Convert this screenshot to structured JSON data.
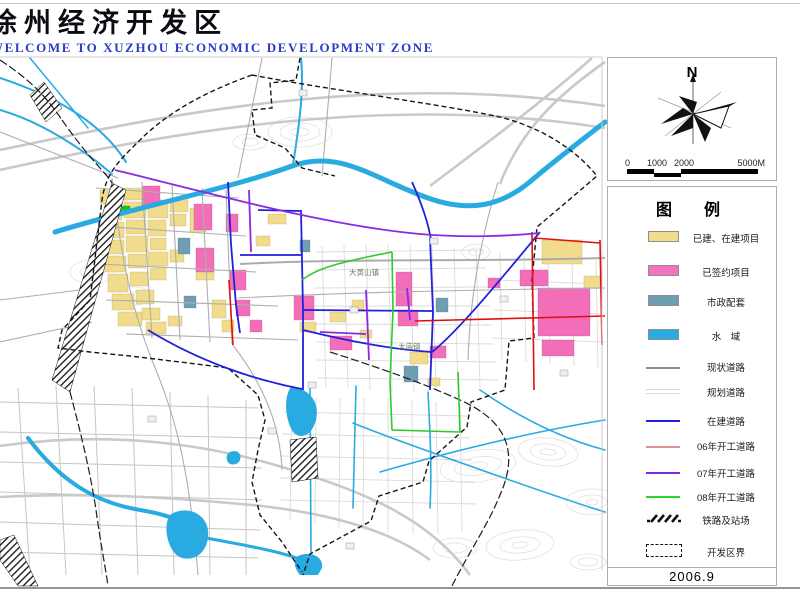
{
  "header": {
    "title": "徐州经济开发区",
    "subtitle": "WELCOME TO XUZHOU ECONOMIC DEVELOPMENT ZONE"
  },
  "compass": {
    "north_label": "N"
  },
  "scale_bar": {
    "ticks": [
      "0",
      "1000",
      "2000",
      "5000M"
    ]
  },
  "legend": {
    "title": "图　例",
    "area_items": [
      {
        "label": "已建、在建项目",
        "color": "#F2DC8E"
      },
      {
        "label": "已签约项目",
        "color": "#F473BC"
      },
      {
        "label": "市政配套",
        "color": "#6F9DB2"
      },
      {
        "label": "水　域",
        "color": "#29ABE2"
      }
    ],
    "line_items": [
      {
        "label": "现状道路",
        "color": "#8C8C8C",
        "style": "solid"
      },
      {
        "label": "规划道路",
        "color": "#D9D9D9",
        "style": "double"
      },
      {
        "label": "在建道路",
        "color": "#2222E0",
        "style": "solid"
      },
      {
        "label": "06年开工道路",
        "color": "#E09090",
        "style": "thin"
      },
      {
        "label": "07年开工道路",
        "color": "#7B2BE0",
        "style": "solid"
      },
      {
        "label": "08年开工道路",
        "color": "#2ED32E",
        "style": "solid"
      }
    ],
    "symbol_items": [
      {
        "label": "铁路及站场",
        "type": "railway"
      },
      {
        "label": "开发区界",
        "type": "boundary"
      }
    ],
    "date": "2006.9"
  },
  "map": {
    "labels": [
      {
        "text": "大黄山镇"
      },
      {
        "text": "大庙镇"
      }
    ],
    "colors": {
      "water": "#29ABE2",
      "built": "#F0DC8C",
      "signed": "#F26EB8",
      "municipal": "#6F9DB2",
      "road_blue": "#2121DC",
      "road_red": "#DE1111",
      "road_purple": "#8A2BE2",
      "road_green": "#2BCB2B"
    }
  }
}
